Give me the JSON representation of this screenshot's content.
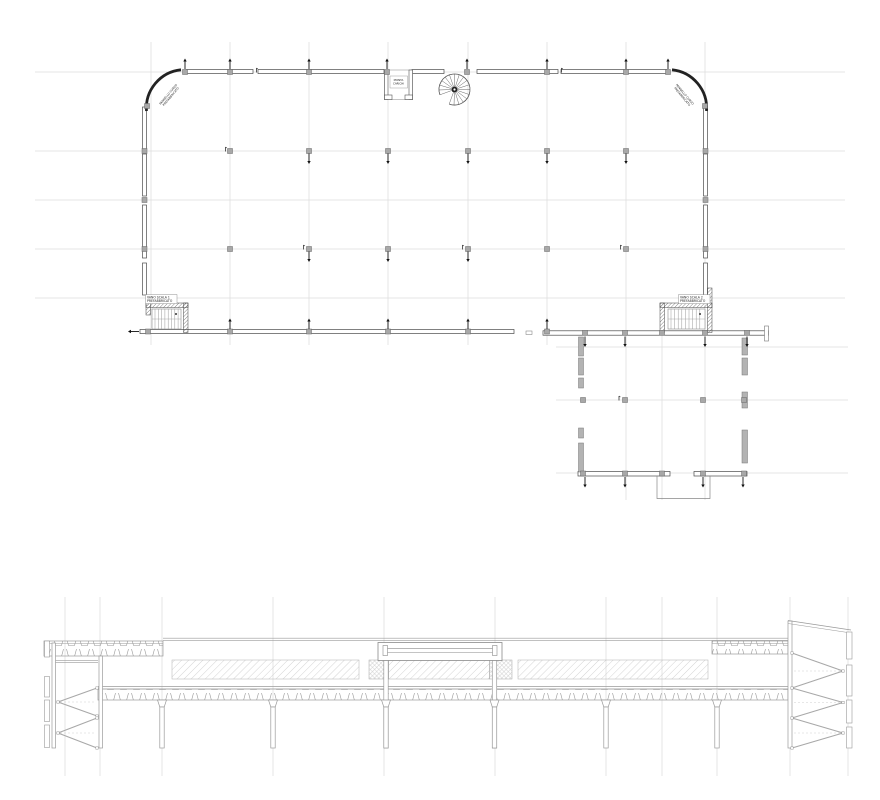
{
  "drawing": {
    "type": "architectural plan and section",
    "sheet_background": "#ffffff"
  },
  "plan": {
    "labels": {
      "stair_left": [
        "VANO SCALA 1",
        "PREFABBRICATO"
      ],
      "stair_right": [
        "VANO SCALA 2",
        "PREFABBRICATO"
      ],
      "elevator": [
        "MONTA",
        "CARICHI"
      ],
      "corner_left": [
        "PANNELLO CURVO",
        "PREFABBRICATO"
      ],
      "corner_right": [
        "PANNELLO CURVO",
        "PREFABBRICATO"
      ]
    }
  },
  "colors": {
    "background": "#ffffff",
    "grid": "#dcdcdc",
    "wall": "#4a4a4a",
    "wall_dark": "#222222",
    "column_fill": "#a8a8a8",
    "column_stroke": "#666666",
    "gray_wall_fill": "#b3b3b3",
    "gray_wall_stroke": "#777777",
    "arrow": "#111111",
    "section_line": "#9a9a9a",
    "hatch_light": "#c9c9c9",
    "hatch_dense": "#bdbdbd",
    "dashed": "#cfcfcf",
    "text": "#222222"
  }
}
